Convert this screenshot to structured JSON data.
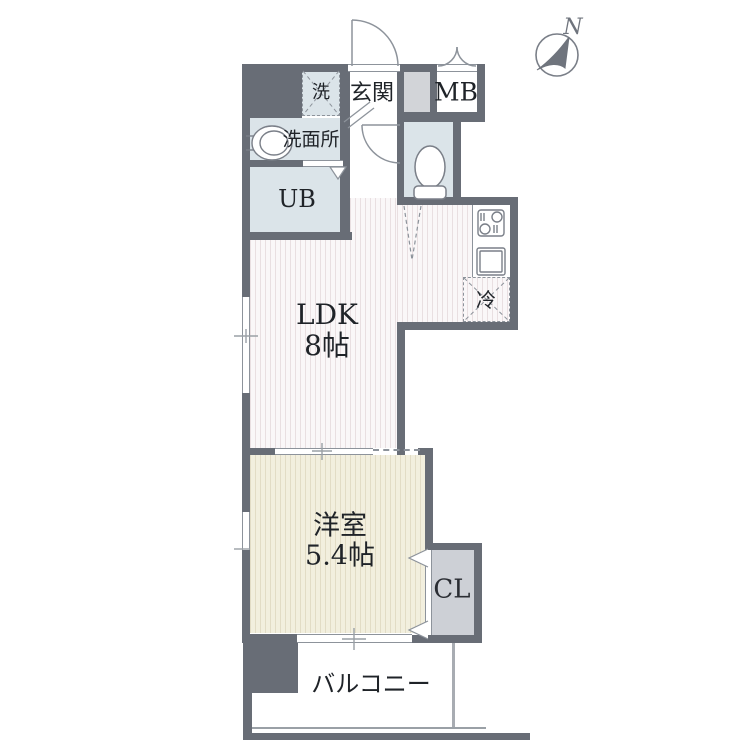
{
  "title": "apartment-floor-plan",
  "compass": {
    "label": "N"
  },
  "rooms": {
    "laundry": {
      "label": "洗"
    },
    "entrance": {
      "label": "玄関"
    },
    "meter_box": {
      "label": "MB"
    },
    "washroom": {
      "label": "洗面所"
    },
    "unit_bath": {
      "label": "UB"
    },
    "refrigerator": {
      "label": "冷"
    },
    "ldk": {
      "name": "LDK",
      "size": "8帖"
    },
    "western_room": {
      "name": "洋室",
      "size": "5.4帖"
    },
    "closet": {
      "label": "CL"
    },
    "balcony": {
      "label": "バルコニー"
    }
  },
  "colors": {
    "wall": "#686d76",
    "wet_area_fill": "#dbe4e9",
    "shaft_fill": "#d2d4d8",
    "closet_fill": "#cdd0d6",
    "ldk_stripe": "#e9dfe1",
    "western_stripe": "#e2dcc5",
    "line": "#8d939b",
    "text": "#1f2328"
  }
}
